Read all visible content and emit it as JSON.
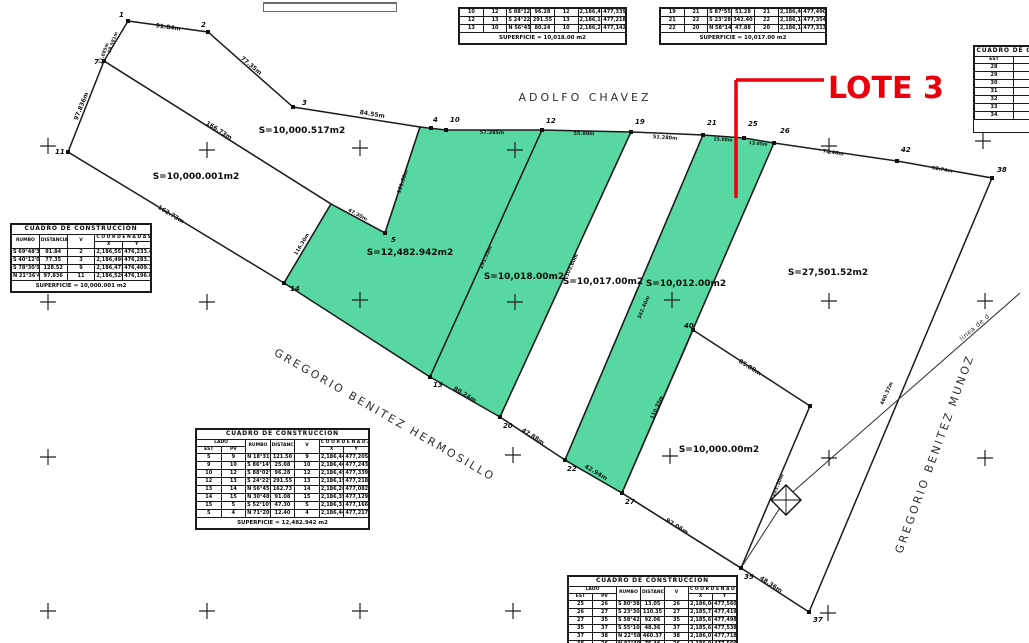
{
  "annotation": {
    "label": "LOTE 3",
    "color": "#e8000d",
    "text": {
      "x": 828,
      "y": 98,
      "fs": 30
    },
    "lines": [
      [
        736,
        80,
        824,
        80
      ],
      [
        736,
        80,
        736,
        198
      ]
    ],
    "stroke_width": 3.5
  },
  "map": {
    "colors": {
      "green": "#57d7a1",
      "line": "#1b1b1b",
      "bg": "#ffffff",
      "cross": "#222222"
    },
    "parcels": [
      {
        "name": "parcel-10000-517",
        "area": "S=10,000.517m2",
        "fill": "white",
        "points": [
          [
            128,
            21
          ],
          [
            208,
            32
          ],
          [
            293,
            107
          ],
          [
            420,
            127
          ],
          [
            385,
            233
          ],
          [
            331,
            204
          ],
          [
            104,
            61
          ]
        ],
        "label": {
          "x": 302,
          "y": 133
        }
      },
      {
        "name": "parcel-10000-001",
        "area": "S=10,000.001m2",
        "fill": "white",
        "points": [
          [
            104,
            61
          ],
          [
            68,
            152
          ],
          [
            284,
            283
          ],
          [
            331,
            204
          ]
        ],
        "label": {
          "x": 196,
          "y": 179
        }
      },
      {
        "name": "parcel-12482-942",
        "area": "S=12,482.942m2",
        "fill": "green",
        "points": [
          [
            420,
            127
          ],
          [
            446,
            130
          ],
          [
            542,
            130
          ],
          [
            430,
            377
          ],
          [
            284,
            283
          ],
          [
            331,
            204
          ],
          [
            385,
            233
          ]
        ],
        "label": {
          "x": 410,
          "y": 255
        }
      },
      {
        "name": "parcel-10018-00",
        "area": "S=10,018.00m2",
        "fill": "green",
        "points": [
          [
            542,
            130
          ],
          [
            631,
            132
          ],
          [
            500,
            417
          ],
          [
            430,
            377
          ]
        ],
        "label": {
          "x": 524,
          "y": 279
        }
      },
      {
        "name": "parcel-10017-00",
        "area": "S=10,017.00m2",
        "fill": "white",
        "points": [
          [
            631,
            132
          ],
          [
            703,
            135
          ],
          [
            565,
            460
          ],
          [
            500,
            417
          ]
        ],
        "label": {
          "x": 603,
          "y": 284
        }
      },
      {
        "name": "parcel-10012-00-lote3",
        "area": "S=10,012.00m2",
        "fill": "green",
        "points": [
          [
            703,
            135
          ],
          [
            744,
            138
          ],
          [
            774,
            143
          ],
          [
            622,
            493
          ],
          [
            565,
            460
          ]
        ],
        "label": {
          "x": 686,
          "y": 286
        }
      },
      {
        "name": "parcel-27501-52",
        "area": "S=27,501.52m2",
        "fill": "white",
        "points": [
          [
            774,
            143
          ],
          [
            897,
            161
          ],
          [
            992,
            178
          ],
          [
            809,
            612
          ],
          [
            741,
            568
          ],
          [
            622,
            493
          ]
        ],
        "label": {
          "x": 828,
          "y": 275
        }
      },
      {
        "name": "parcel-10000-00",
        "area": "S=10,000.00m2",
        "fill": "white",
        "points": [
          [
            693,
            330
          ],
          [
            810,
            406
          ],
          [
            741,
            568
          ],
          [
            622,
            493
          ]
        ],
        "label": {
          "x": 719,
          "y": 452
        }
      }
    ],
    "lines": [
      {
        "name": "street-centerline",
        "pts": [
          [
            1020,
            293
          ],
          [
            787,
            497
          ],
          [
            741,
            568
          ]
        ],
        "w": 1.1
      }
    ],
    "vertices": [
      {
        "n": "1",
        "x": 128,
        "y": 21,
        "lx": 119,
        "ly": 17
      },
      {
        "n": "2",
        "x": 208,
        "y": 32,
        "lx": 201,
        "ly": 27
      },
      {
        "n": "3",
        "x": 293,
        "y": 107,
        "lx": 302,
        "ly": 105
      },
      {
        "n": "7",
        "x": 104,
        "y": 61,
        "lx": 94,
        "ly": 64
      },
      {
        "n": "11",
        "x": 68,
        "y": 152,
        "lx": 55,
        "ly": 154
      },
      {
        "n": "4",
        "x": 431,
        "y": 128,
        "lx": 433,
        "ly": 122
      },
      {
        "n": "10",
        "x": 446,
        "y": 130,
        "lx": 450,
        "ly": 122
      },
      {
        "n": "12",
        "x": 542,
        "y": 130,
        "lx": 546,
        "ly": 123
      },
      {
        "n": "19",
        "x": 631,
        "y": 132,
        "lx": 635,
        "ly": 124
      },
      {
        "n": "21",
        "x": 703,
        "y": 135,
        "lx": 707,
        "ly": 125
      },
      {
        "n": "25",
        "x": 744,
        "y": 138,
        "lx": 748,
        "ly": 126
      },
      {
        "n": "26",
        "x": 774,
        "y": 143,
        "lx": 780,
        "ly": 133
      },
      {
        "n": "42",
        "x": 897,
        "y": 161,
        "lx": 901,
        "ly": 152
      },
      {
        "n": "38",
        "x": 992,
        "y": 178,
        "lx": 997,
        "ly": 172
      },
      {
        "n": "5",
        "x": 385,
        "y": 233,
        "lx": 391,
        "ly": 242
      },
      {
        "n": "13",
        "x": 430,
        "y": 377,
        "lx": 433,
        "ly": 387
      },
      {
        "n": "14",
        "x": 284,
        "y": 283,
        "lx": 290,
        "ly": 291
      },
      {
        "n": "20",
        "x": 500,
        "y": 417,
        "lx": 503,
        "ly": 428
      },
      {
        "n": "22",
        "x": 565,
        "y": 460,
        "lx": 567,
        "ly": 471
      },
      {
        "n": "27",
        "x": 622,
        "y": 493,
        "lx": 625,
        "ly": 504
      },
      {
        "n": "35",
        "x": 741,
        "y": 568,
        "lx": 744,
        "ly": 579
      },
      {
        "n": "37",
        "x": 809,
        "y": 612,
        "lx": 813,
        "ly": 622
      },
      {
        "n": "40",
        "x": 693,
        "y": 330,
        "lx": 684,
        "ly": 328
      },
      {
        "n": "",
        "x": 810,
        "y": 406,
        "lx": 0,
        "ly": 0
      }
    ],
    "edge_labels": [
      {
        "t": "91.84m",
        "x": 168,
        "y": 29,
        "r": 8,
        "fs": 6
      },
      {
        "t": "77.35m",
        "x": 250,
        "y": 67,
        "r": 40,
        "fs": 6
      },
      {
        "t": "84.55m",
        "x": 372,
        "y": 116,
        "r": 9,
        "fs": 6
      },
      {
        "t": "18.581m",
        "x": 114,
        "y": 43,
        "r": -70,
        "fs": 4.5
      },
      {
        "t": "11.685m",
        "x": 105,
        "y": 54,
        "r": -70,
        "fs": 4.5
      },
      {
        "t": "97.836m",
        "x": 83,
        "y": 107,
        "r": -68,
        "fs": 6
      },
      {
        "t": "166.73m",
        "x": 218,
        "y": 132,
        "r": 32,
        "fs": 6
      },
      {
        "t": "162.73m",
        "x": 170,
        "y": 216,
        "r": 31,
        "fs": 6
      },
      {
        "t": "116.30m",
        "x": 303,
        "y": 245,
        "r": -59,
        "fs": 5
      },
      {
        "t": "47.30m",
        "x": 357,
        "y": 216,
        "r": 28,
        "fs": 5
      },
      {
        "t": "121.50m",
        "x": 404,
        "y": 182,
        "r": -71,
        "fs": 5
      },
      {
        "t": "57.285m",
        "x": 492,
        "y": 134,
        "r": 1,
        "fs": 5
      },
      {
        "t": "55.00m",
        "x": 584,
        "y": 135,
        "r": 1,
        "fs": 5
      },
      {
        "t": "51.280m",
        "x": 665,
        "y": 139,
        "r": 4,
        "fs": 5
      },
      {
        "t": "25.08m",
        "x": 723,
        "y": 141,
        "r": 3,
        "fs": 4.5
      },
      {
        "t": "13.05m",
        "x": 758,
        "y": 145,
        "r": 6,
        "fs": 4.5
      },
      {
        "t": "75.46m",
        "x": 833,
        "y": 154,
        "r": 9,
        "fs": 5
      },
      {
        "t": "62.74m",
        "x": 942,
        "y": 171,
        "r": 10,
        "fs": 5
      },
      {
        "t": "291.55m",
        "x": 487,
        "y": 258,
        "r": -66,
        "fs": 5
      },
      {
        "t": "305.60m",
        "x": 573,
        "y": 266,
        "r": -65,
        "fs": 5
      },
      {
        "t": "342.40m",
        "x": 645,
        "y": 308,
        "r": -67,
        "fs": 5
      },
      {
        "t": "110.35m",
        "x": 658,
        "y": 408,
        "r": -66,
        "fs": 5
      },
      {
        "t": "80.24m",
        "x": 464,
        "y": 396,
        "r": 31,
        "fs": 6
      },
      {
        "t": "47.88m",
        "x": 532,
        "y": 438,
        "r": 33,
        "fs": 6
      },
      {
        "t": "42.94m",
        "x": 595,
        "y": 474,
        "r": 31,
        "fs": 6
      },
      {
        "t": "92.06m",
        "x": 676,
        "y": 528,
        "r": 32,
        "fs": 6
      },
      {
        "t": "48.36m",
        "x": 770,
        "y": 586,
        "r": 33,
        "fs": 6
      },
      {
        "t": "85.88m",
        "x": 749,
        "y": 369,
        "r": 32,
        "fs": 6
      },
      {
        "t": "103.50m",
        "x": 779,
        "y": 486,
        "r": -67,
        "fs": 5
      },
      {
        "t": "460.37m",
        "x": 888,
        "y": 394,
        "r": -66,
        "fs": 5
      }
    ],
    "streets": [
      {
        "name": "ADOLFO CHAVEZ",
        "x": 585,
        "y": 101,
        "r": 0,
        "fs": 11,
        "ls": 3
      },
      {
        "name": "GREGORIO BENITEZ HERMOSILLO",
        "x": 383,
        "y": 418,
        "r": 30,
        "fs": 11,
        "ls": 2.5
      },
      {
        "name": "GREGORIO BENITEZ MUNOZ",
        "x": 938,
        "y": 455,
        "r": -70,
        "fs": 11,
        "ls": 2.5
      },
      {
        "name": "linea de d",
        "x": 976,
        "y": 329,
        "r": -41,
        "fs": 6.5,
        "ls": 0.5
      }
    ],
    "crosses": [
      [
        48,
        146
      ],
      [
        207,
        150
      ],
      [
        360,
        148
      ],
      [
        515,
        150
      ],
      [
        829,
        146
      ],
      [
        983,
        141
      ],
      [
        48,
        302
      ],
      [
        207,
        302
      ],
      [
        360,
        300
      ],
      [
        515,
        302
      ],
      [
        672,
        300
      ],
      [
        829,
        301
      ],
      [
        985,
        301
      ],
      [
        48,
        457
      ],
      [
        207,
        457
      ],
      [
        513,
        455
      ],
      [
        670,
        456
      ],
      [
        829,
        458
      ],
      [
        985,
        458
      ],
      [
        48,
        611
      ],
      [
        207,
        611
      ],
      [
        360,
        611
      ],
      [
        513,
        611
      ],
      [
        828,
        613
      ]
    ],
    "compass": {
      "x": 786,
      "y": 500,
      "r": 15
    }
  },
  "topbar": {
    "x": 263,
    "y": 2,
    "w": 132,
    "h": 7
  },
  "tables": {
    "labels": {
      "title": "CUADRO DE CONSTRUCCION",
      "lado": "LADO",
      "est": "EST",
      "pv": "PV",
      "rumbo": "RUMBO",
      "distancia": "DISTANCIA",
      "v": "V",
      "coordenadas": "C O O R D E N A D A S",
      "x": "X",
      "y": "Y"
    },
    "top_a": {
      "x": 458,
      "y": 7,
      "w": 169,
      "rows": [
        [
          "10",
          "12",
          "S 88°12'40\" E",
          "96.28",
          "12",
          "2,186,456.84",
          "477,339.24"
        ],
        [
          "12",
          "13",
          "S 24°22'46\" W",
          "291.55",
          "13",
          "2,186,191.30",
          "477,218.92"
        ],
        [
          "13",
          "10",
          "N 56°45'10\" W",
          "80.24",
          "10",
          "2,186,230.48",
          "477,142.79"
        ]
      ],
      "footer": "SUPERFICIE = 10,018.00 m2"
    },
    "top_b": {
      "x": 659,
      "y": 7,
      "w": 168,
      "rows": [
        [
          "19",
          "21",
          "S 87°55'08\" E",
          "51.28",
          "21",
          "2,186,452.10",
          "477,490.55"
        ],
        [
          "21",
          "22",
          "S 23°28'40\" W",
          "342.40",
          "22",
          "2,186,138.25",
          "477,354.06"
        ],
        [
          "22",
          "20",
          "N 58°14'30\" W",
          "47.88",
          "20",
          "2,186,163.47",
          "477,313.88"
        ]
      ],
      "footer": "SUPERFICIE = 10,017.00 m2"
    },
    "right_partial": {
      "x": 973,
      "y": 45,
      "w": 120,
      "title": "CUADRO DE CONSTRUCCION",
      "rows": [
        [
          "28",
          "41",
          "1,2"
        ],
        [
          "29",
          "42",
          "1,5"
        ],
        [
          "30",
          "43",
          "2,1"
        ],
        [
          "31",
          "44",
          "1,8"
        ],
        [
          "32",
          "45",
          "2,4"
        ],
        [
          "33",
          "46",
          "1,9"
        ],
        [
          "34",
          "47",
          "2,2"
        ]
      ]
    },
    "left": {
      "x": 10,
      "y": 223,
      "w": 142,
      "title": "CUADRO DE CONSTRUCCION",
      "rows": [
        [
          "S 69°48'31\" E",
          "91.84",
          "2",
          "2,186,557.29",
          "476,233.41"
        ],
        [
          "S 40°12'08\" E",
          "77.35",
          "3",
          "2,186,498.22",
          "476,283.37"
        ],
        [
          "S 78°30'54\" E",
          "128.52",
          "9",
          "2,186,472.84",
          "476,409.29"
        ],
        [
          "N 21°36'40\" W",
          "97.836",
          "11",
          "2,186,520.11",
          "476,196.05"
        ]
      ],
      "footer": "SUPERFICIE = 10,000.001 m2"
    },
    "center": {
      "x": 195,
      "y": 428,
      "w": 175,
      "title": "CUADRO DE CONSTRUCCION",
      "rows": [
        [
          "5",
          "9",
          "N 18°31'47\" E",
          "121.50",
          "9",
          "2,186,444.92",
          "477,205.37"
        ],
        [
          "9",
          "10",
          "S 86°14'32\" E",
          "25.08",
          "10",
          "2,186,460.17",
          "477,243.02"
        ],
        [
          "10",
          "12",
          "S 88°02'11\" E",
          "96.28",
          "12",
          "2,186,456.84",
          "477,339.24"
        ],
        [
          "12",
          "13",
          "S 24°22'46\" W",
          "291.55",
          "13",
          "2,186,191.30",
          "477,218.92"
        ],
        [
          "13",
          "14",
          "N 56°45'10\" W",
          "162.73",
          "14",
          "2,186,280.48",
          "477,082.79"
        ],
        [
          "14",
          "15",
          "N 30°48'22\" E",
          "91.08",
          "15",
          "2,186,358.71",
          "477,129.44"
        ],
        [
          "15",
          "5",
          "S 52°10'05\" E",
          "47.30",
          "5",
          "2,186,329.69",
          "477,166.80"
        ],
        [
          "5",
          "4",
          "N 71°20'15\" E",
          "12.40",
          "4",
          "2,186,448.90",
          "477,217.12"
        ]
      ],
      "footer": "SUPERFICIE = 12,482.942 m2"
    },
    "bottom": {
      "x": 567,
      "y": 575,
      "w": 171,
      "title": "CUADRO DE CONSTRUCCION",
      "rows": [
        [
          "25",
          "26",
          "S 80°38'20\" E",
          "13.05",
          "26",
          "2,186,049.60",
          "477,560.04"
        ],
        [
          "26",
          "27",
          "S 23°30'12\" W",
          "110.35",
          "27",
          "2,185,725.94",
          "477,419.86"
        ],
        [
          "27",
          "35",
          "S 58°42'50\" E",
          "92.06",
          "35",
          "2,185,677.70",
          "477,498.32"
        ],
        [
          "35",
          "37",
          "S 55°10'08\" E",
          "48.36",
          "37",
          "2,185,650.02",
          "477,538.70"
        ],
        [
          "37",
          "38",
          "N 22°58'44\" E",
          "460.37",
          "38",
          "2,186,074.15",
          "477,718.55"
        ],
        [
          "38",
          "26",
          "N 81°40'22\" W",
          "75.46",
          "26",
          "2,186,049.60",
          "477,560.04"
        ]
      ]
    }
  }
}
